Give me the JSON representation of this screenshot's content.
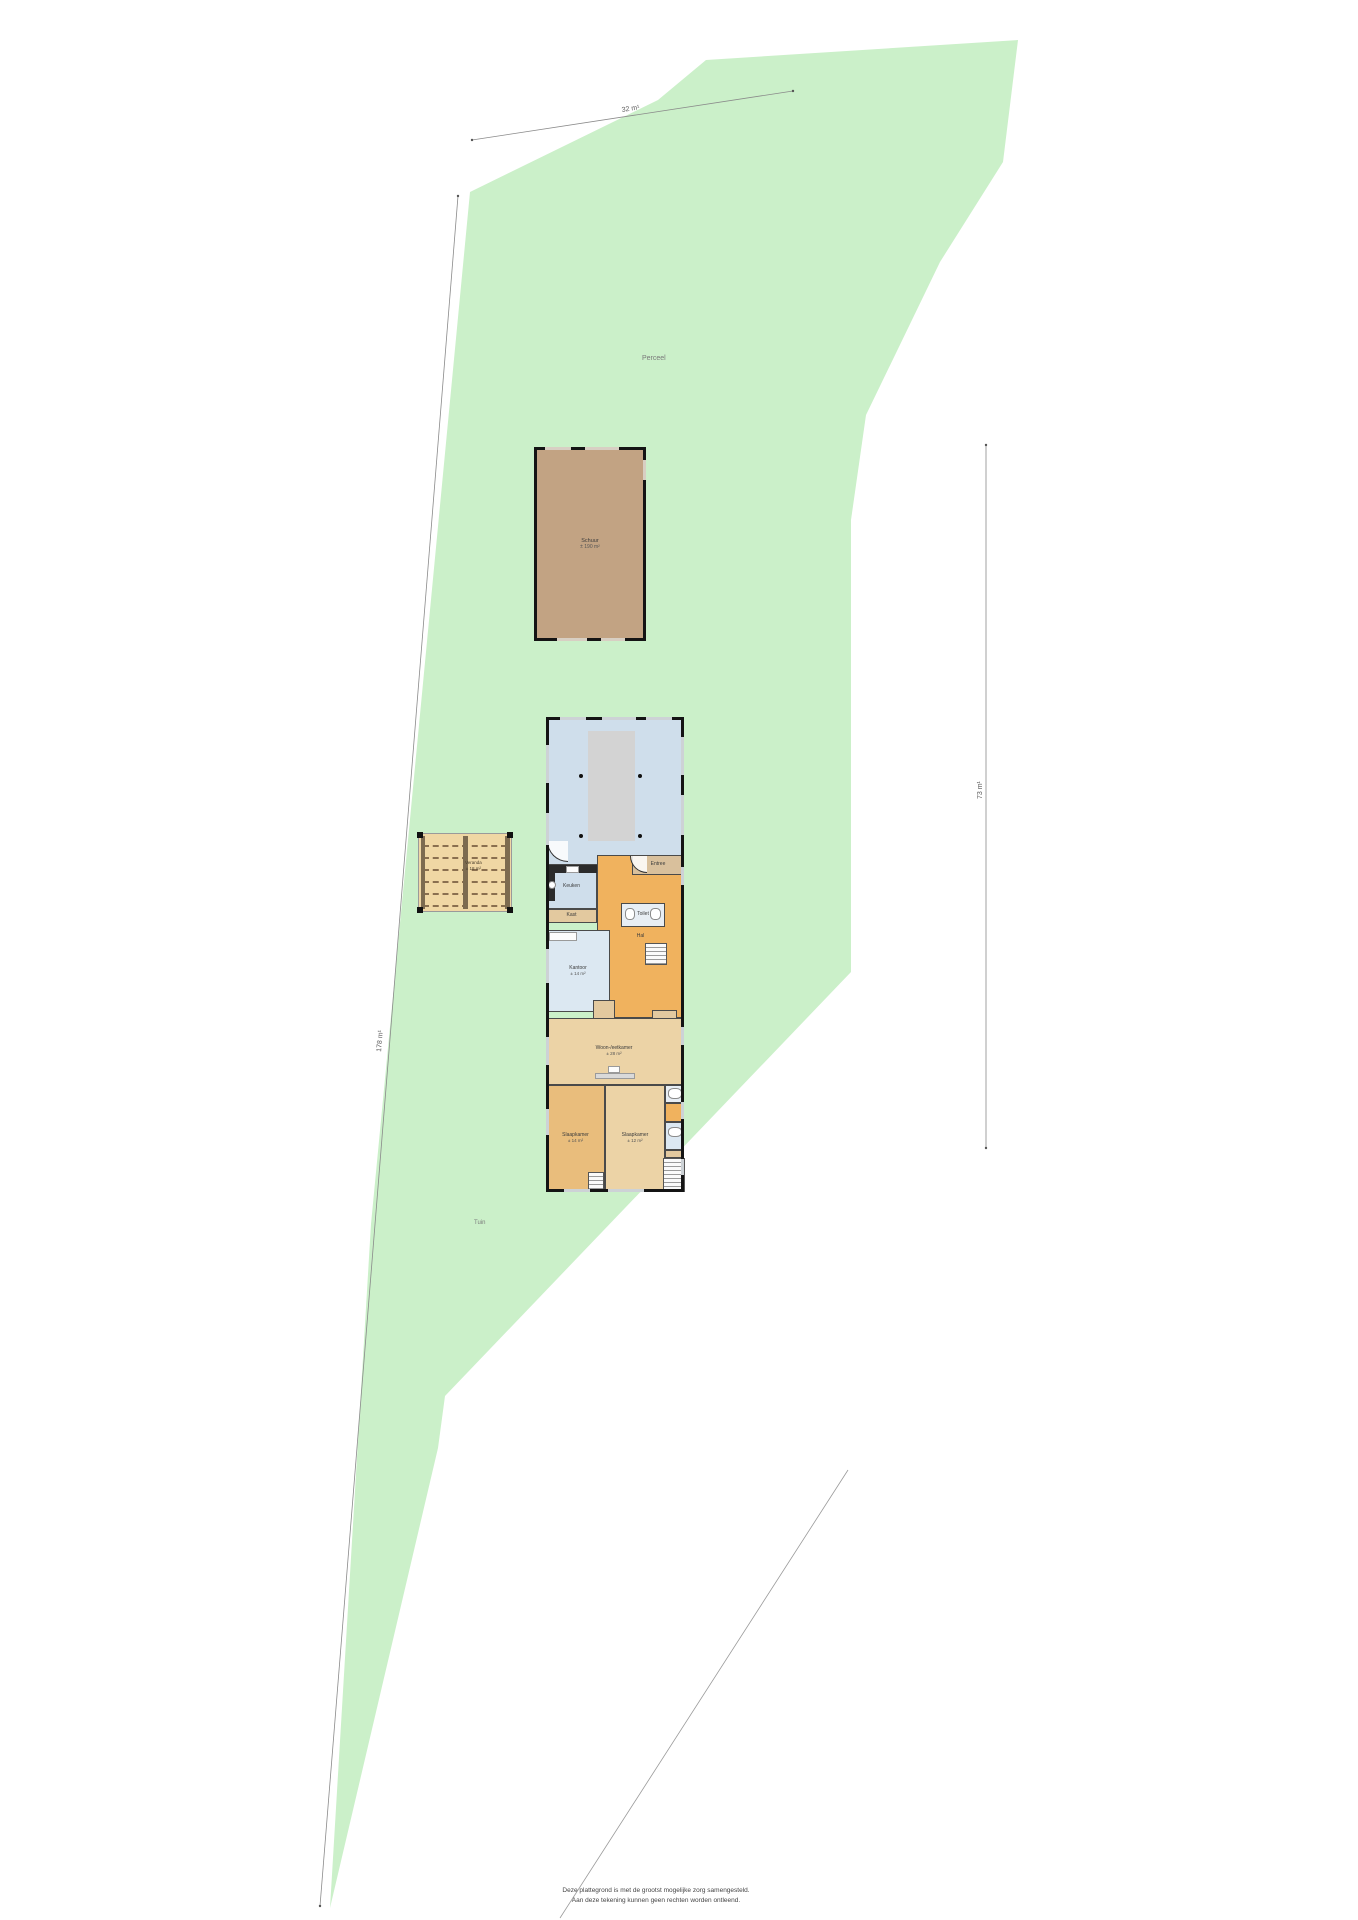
{
  "site": {
    "parcel_label": "Perceel",
    "garden_label": "Tuin",
    "caption": {
      "line1": "Deze plattegrond is met de grootst mogelijke zorg samengesteld.",
      "line2": "Aan deze tekening kunnen geen rechten worden ontleend."
    },
    "colors": {
      "parcel_green": "#cbf0c9",
      "barn_fill": "#c2a383",
      "deck_fill": "#f0d7a4",
      "wall_black": "#141414",
      "hall_orange": "#f0b25e",
      "room_blue": "#cfdeeb",
      "room_tan": "#ecd3a6"
    }
  },
  "dimensions": {
    "top": "32 m¹",
    "left": "178 m¹",
    "right": "73 m¹"
  },
  "buildings": {
    "barn": {
      "label": "Schuur",
      "area": "± 190 m²"
    },
    "veranda": {
      "label": "Veranda",
      "area": "± 18 m²"
    },
    "house": {
      "rooms": [
        {
          "id": "woonkamer",
          "label": "Woonkamer",
          "area": "± 62 m²",
          "x": 0,
          "y": 0,
          "w": 138,
          "h": 148,
          "color": "#cfdeeb"
        },
        {
          "id": "hal",
          "label": "Hal",
          "area": "",
          "x": 51,
          "y": 138,
          "w": 87,
          "h": 163,
          "color": "#f0b25e"
        },
        {
          "id": "entree",
          "label": "Entree",
          "area": "",
          "x": 86,
          "y": 138,
          "w": 52,
          "h": 20,
          "color": "#d9c09c"
        },
        {
          "id": "keuken",
          "label": "Keuken",
          "area": "",
          "x": 0,
          "y": 148,
          "w": 51,
          "h": 44,
          "color": "#cfdeeb"
        },
        {
          "id": "kast-1",
          "label": "Kast",
          "area": "",
          "x": 0,
          "y": 192,
          "w": 51,
          "h": 14,
          "color": "#e3c99f"
        },
        {
          "id": "toilet",
          "label": "Toilet",
          "area": "",
          "x": 75,
          "y": 186,
          "w": 44,
          "h": 24,
          "color": "#e8eef4"
        },
        {
          "id": "kantoor",
          "label": "Kantoor",
          "area": "± 14 m²",
          "x": 0,
          "y": 213,
          "w": 64,
          "h": 82,
          "color": "#dce8f2"
        },
        {
          "id": "kast-2",
          "label": "",
          "area": "",
          "x": 47,
          "y": 283,
          "w": 22,
          "h": 30,
          "color": "#e3c99f"
        },
        {
          "id": "kast-3",
          "label": "",
          "area": "",
          "x": 106,
          "y": 293,
          "w": 25,
          "h": 10,
          "color": "#e3c99f"
        },
        {
          "id": "eetkamer",
          "label": "Woon-/eetkamer",
          "area": "± 28 m²",
          "x": 0,
          "y": 301,
          "w": 136,
          "h": 67,
          "color": "#ecd3a6"
        },
        {
          "id": "slaapkamer-1",
          "label": "Slaapkamer",
          "area": "± 14 m²",
          "x": 0,
          "y": 368,
          "w": 59,
          "h": 107,
          "color": "#e9bd7c"
        },
        {
          "id": "slaapkamer-2",
          "label": "Slaapkamer",
          "area": "± 12 m²",
          "x": 59,
          "y": 368,
          "w": 60,
          "h": 107,
          "color": "#ecd3a6"
        },
        {
          "id": "badkamer-1",
          "label": "",
          "area": "",
          "x": 119,
          "y": 368,
          "w": 19,
          "h": 18,
          "color": "#e8eef4"
        },
        {
          "id": "kast-4",
          "label": "",
          "area": "",
          "x": 119,
          "y": 386,
          "w": 19,
          "h": 19,
          "color": "#f0b25e"
        },
        {
          "id": "badkamer-2",
          "label": "",
          "area": "",
          "x": 119,
          "y": 405,
          "w": 19,
          "h": 28,
          "color": "#dce8f2"
        },
        {
          "id": "hal-2",
          "label": "",
          "area": "",
          "x": 119,
          "y": 433,
          "w": 19,
          "h": 8,
          "color": "#e3c99f"
        }
      ]
    }
  }
}
